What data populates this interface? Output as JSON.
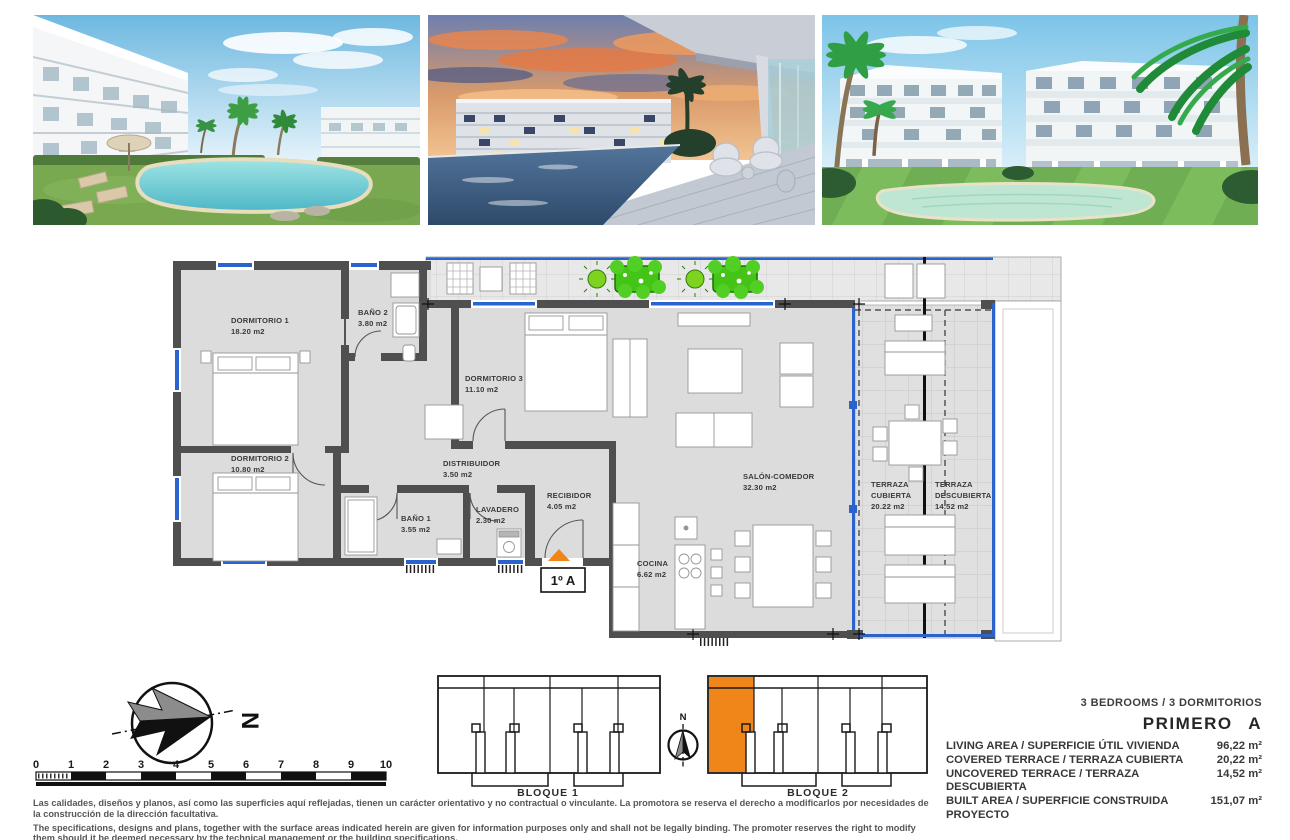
{
  "photos": [
    {
      "alt": "Residential complex with lagoon-style pool, lawn, sun loungers and palm trees"
    },
    {
      "alt": "Sunset view from a covered terrace over the pool and apartment block"
    },
    {
      "alt": "White apartment buildings with communal pool, lawn and palm trees"
    }
  ],
  "floorplan": {
    "unit_label": "1º A",
    "rooms": [
      {
        "name": "DORMITORIO 1",
        "area": "18.20 m2"
      },
      {
        "name": "BAÑO 2",
        "area": "3.80 m2"
      },
      {
        "name": "DORMITORIO 3",
        "area": "11.10 m2"
      },
      {
        "name": "DORMITORIO 2",
        "area": "10.80 m2"
      },
      {
        "name": "DISTRIBUIDOR",
        "area": "3.50 m2"
      },
      {
        "name": "BAÑO 1",
        "area": "3.55 m2"
      },
      {
        "name": "LAVADERO",
        "area": "2.30 m2"
      },
      {
        "name": "RECIBIDOR",
        "area": "4.05 m2"
      },
      {
        "name": "SALÓN-COMEDOR",
        "area": "32.30 m2"
      },
      {
        "name": "COCINA",
        "area": "6.62 m2"
      }
    ],
    "terraces": [
      {
        "line1": "TERRAZA",
        "line2": "CUBIERTA",
        "area": "20.22 m2"
      },
      {
        "line1": "TERRAZA",
        "line2": "DESCUBIERTA",
        "area": "14.52 m2"
      }
    ]
  },
  "compass": {
    "letter": "N"
  },
  "scalebar": {
    "ticks": [
      "0",
      "1",
      "2",
      "3",
      "4",
      "5",
      "6",
      "7",
      "8",
      "9",
      "10"
    ]
  },
  "blocks": {
    "block1": "BLOQUE 1",
    "block2": "BLOQUE 2",
    "north": "N",
    "highlight_color": "#F08519"
  },
  "specs": {
    "bedrooms": "3 BEDROOMS / 3 DORMITORIOS",
    "unit_title": "PRIMERO A",
    "rows": [
      {
        "label": "LIVING AREA / SUPERFICIE ÚTIL VIVIENDA",
        "value": "96,22 m²"
      },
      {
        "label": "COVERED TERRACE / TERRAZA CUBIERTA",
        "value": "20,22 m²"
      },
      {
        "label": "UNCOVERED TERRACE / TERRAZA DESCUBIERTA",
        "value": "14,52 m²"
      },
      {
        "label": "BUILT AREA / SUPERFICIE CONSTRUIDA PROYECTO",
        "value": "151,07 m²"
      }
    ]
  },
  "disclaimer": {
    "es": "Las calidades, diseños y planos, así como las superficies aquí reflejadas, tienen un carácter orientativo y no contractual o vinculante. La promotora se reserva el derecho a modificarlos por necesidades de la construcción de la dirección facultativa.",
    "en": "The specifications, designs and plans, together with the surface areas indicated herein are given for information purposes only and shall not be legally binding. The promoter reserves the right to modify them should it be deemed necessary by the technical management or the building specifications."
  },
  "colors": {
    "wall": "#4f4f4f",
    "floor": "#dcdcdc",
    "glazing_blue": "#2b63cc",
    "plant_green": "#4cc41c",
    "highlight_orange": "#F08519"
  }
}
